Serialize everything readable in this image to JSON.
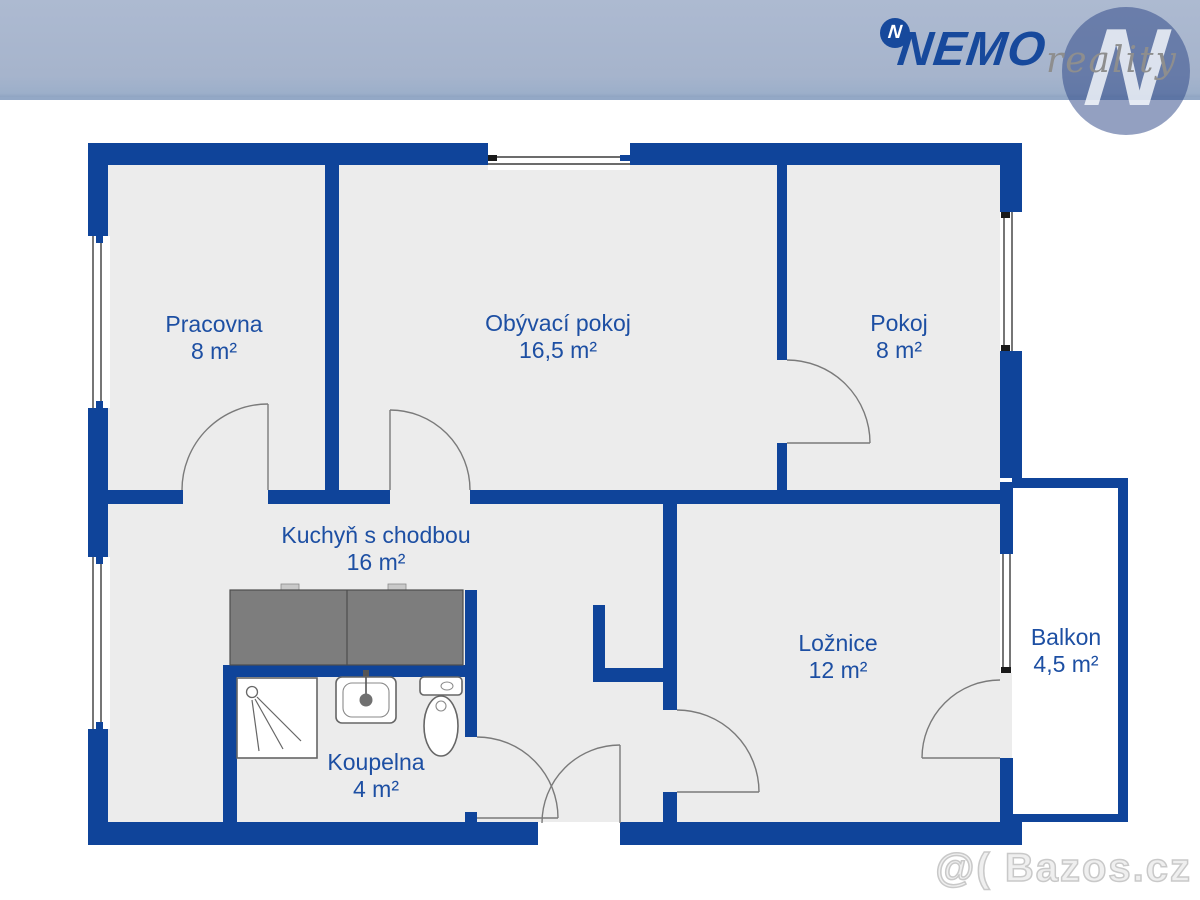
{
  "header": {
    "brand": "NEMO",
    "brand_suffix": "reality",
    "logo_letter": "N"
  },
  "watermark": "@( Bazos.cz",
  "colors": {
    "band": "#a6b4cc",
    "wall": "#0f449a",
    "room_fill": "#ececec",
    "label_text": "#1d4fa3",
    "counter_fill": "#7d7d7d"
  },
  "floorplan": {
    "rooms": [
      {
        "id": "pracovna",
        "name": "Pracovna",
        "area": "8 m²"
      },
      {
        "id": "obyvaci",
        "name": "Obývací pokoj",
        "area": "16,5 m²"
      },
      {
        "id": "pokoj",
        "name": "Pokoj",
        "area": "8 m²"
      },
      {
        "id": "kuchyn",
        "name": "Kuchyň s chodbou",
        "area": "16 m²"
      },
      {
        "id": "koupelna",
        "name": "Koupelna",
        "area": "4 m²"
      },
      {
        "id": "loznice",
        "name": "Ložnice",
        "area": "12 m²"
      },
      {
        "id": "balkon",
        "name": "Balkon",
        "area": "4,5 m²"
      }
    ]
  }
}
